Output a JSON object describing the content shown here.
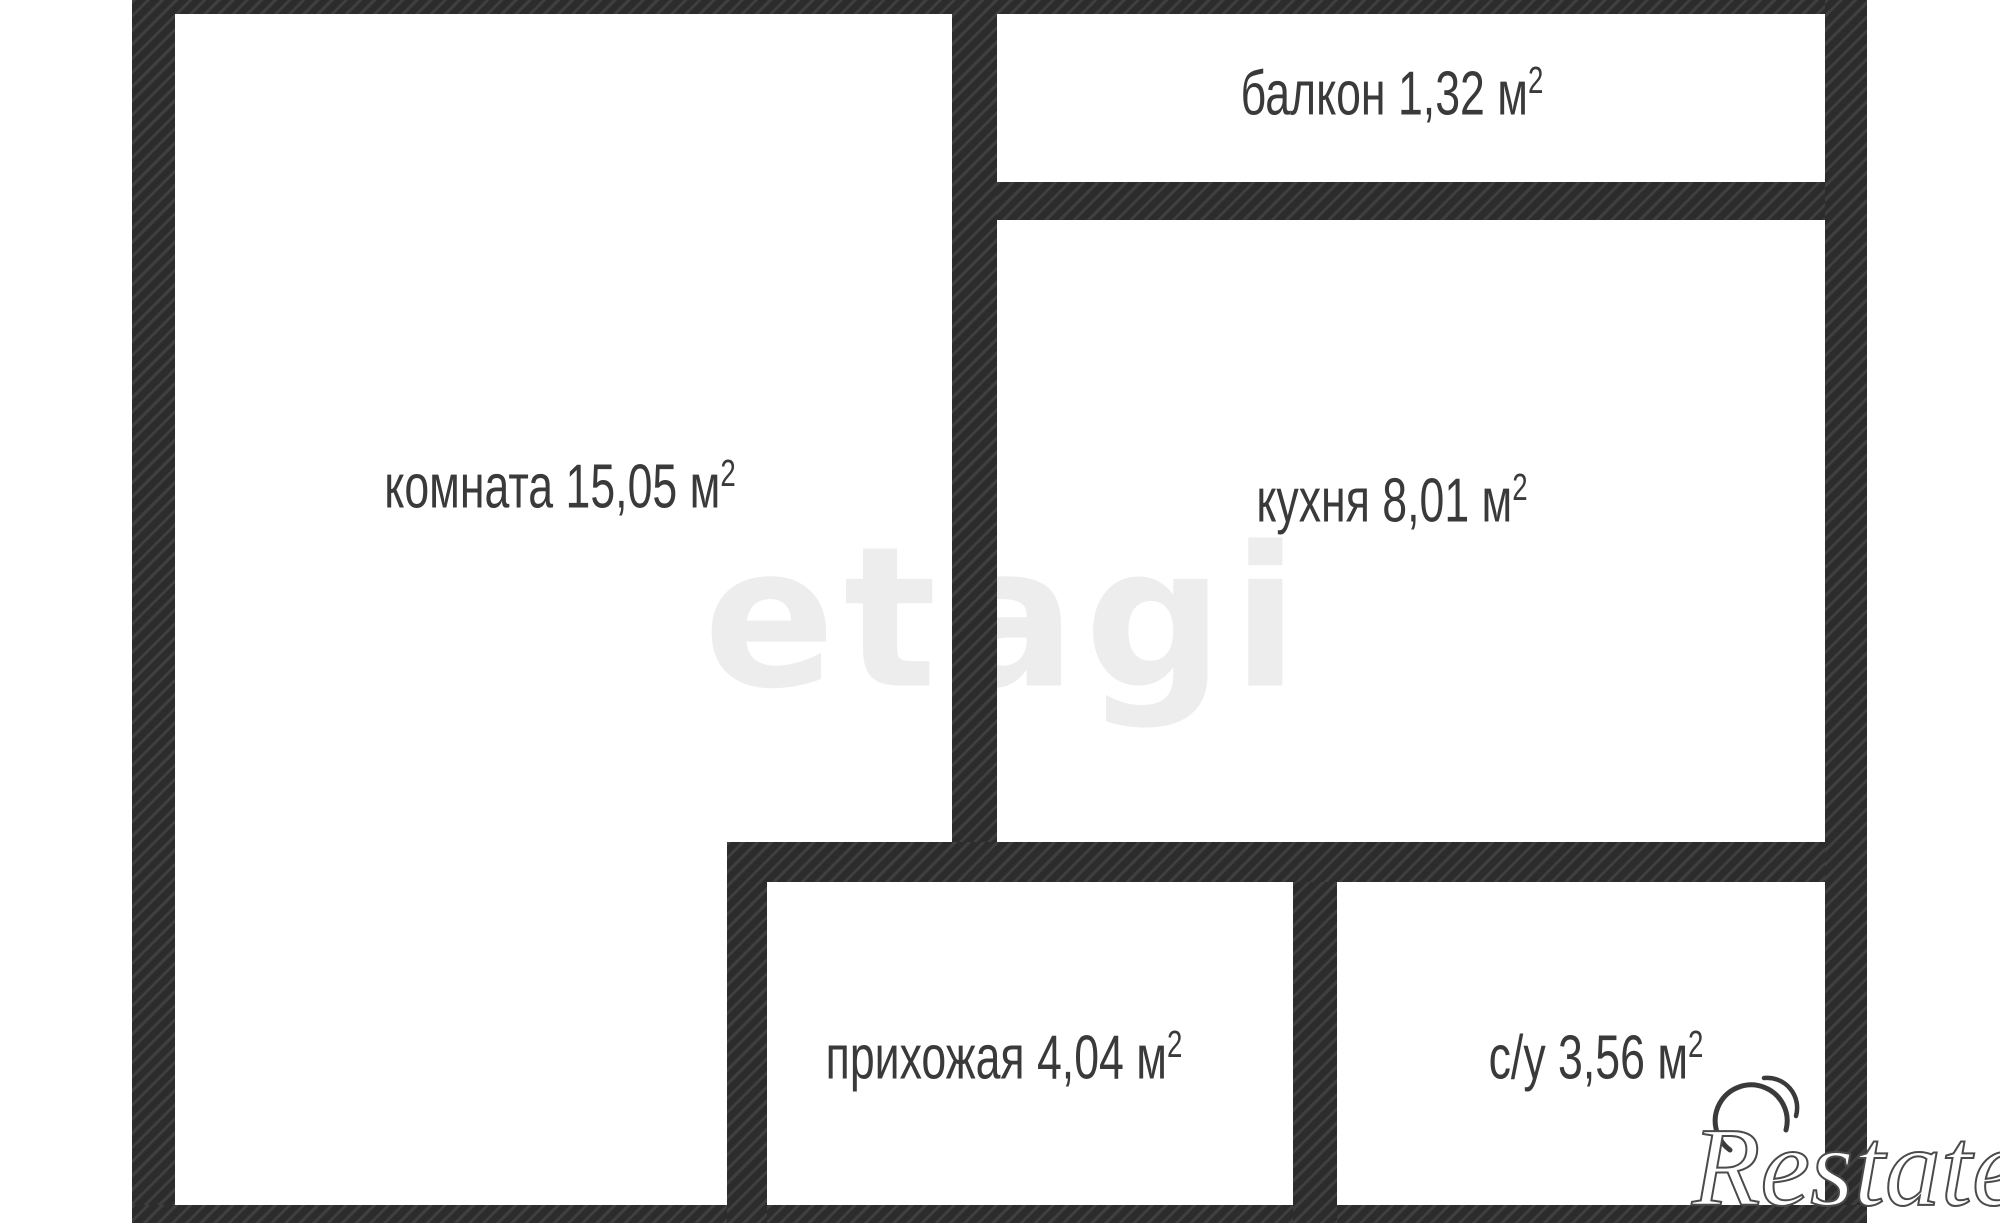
{
  "plan": {
    "rooms": [
      {
        "name": "komnata",
        "label": "комната 15,05 м",
        "sup": "2"
      },
      {
        "name": "balkon",
        "label": "балкон 1,32 м",
        "sup": "2"
      },
      {
        "name": "kuhnya",
        "label": "кухня 8,01 м",
        "sup": "2"
      },
      {
        "name": "prihozhaya",
        "label": "прихожая 4,04 м",
        "sup": "2"
      },
      {
        "name": "su",
        "label": "с/у 3,56 м",
        "sup": "2"
      }
    ]
  },
  "watermarks": {
    "center": "etagi",
    "brand": "Restate"
  },
  "colors": {
    "background": "#ffffff",
    "wall-base": "#3f3f3f",
    "wall-stripe": "#2c2c2c",
    "label-text": "#3a3a3a",
    "watermark": "#ededed",
    "brand-fill": "#ffffff",
    "brand-outline": "#4b4b4b"
  }
}
